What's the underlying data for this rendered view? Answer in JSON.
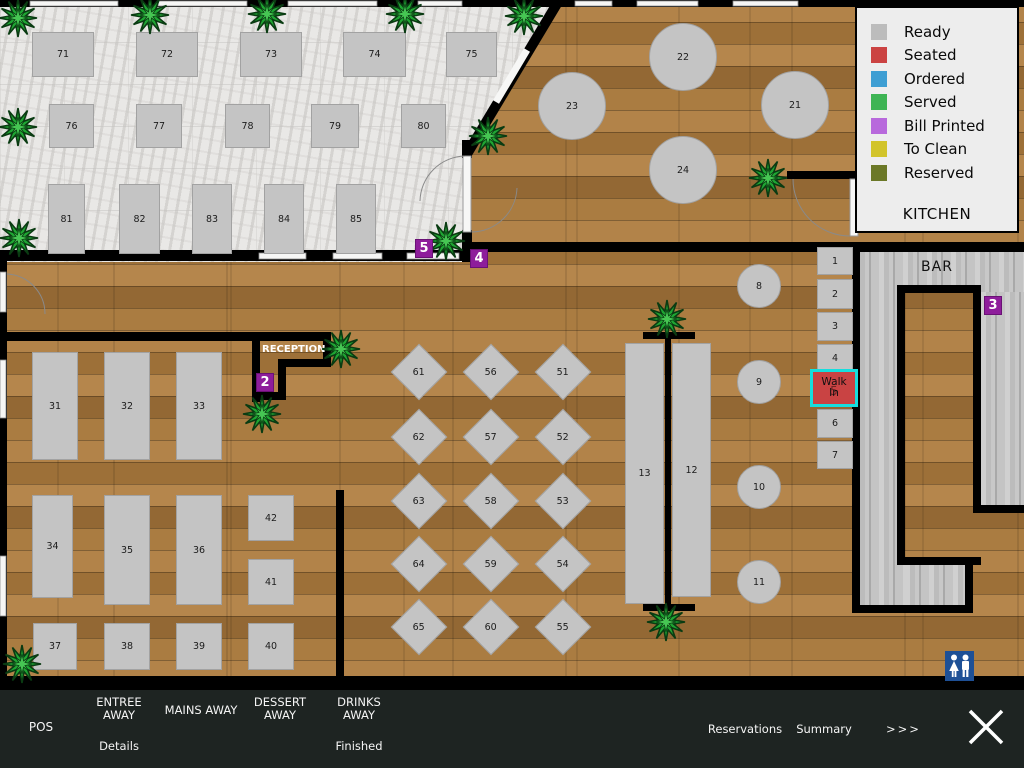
{
  "legend": {
    "items": [
      {
        "label": "Ready",
        "color": "#bcbcbc"
      },
      {
        "label": "Seated",
        "color": "#cb4342"
      },
      {
        "label": "Ordered",
        "color": "#3e9ed3"
      },
      {
        "label": "Served",
        "color": "#3eb454"
      },
      {
        "label": "Bill Printed",
        "color": "#b869dc"
      },
      {
        "label": "To Clean",
        "color": "#d2c42b"
      },
      {
        "label": "Reserved",
        "color": "#6b7827"
      }
    ],
    "kitchen_label": "KITCHEN"
  },
  "floor": {
    "bar_label": "BAR",
    "reception_label": "RECEPTION"
  },
  "walk_in": {
    "line1": "Walk",
    "line2": "In",
    "table_number": "5",
    "status": "seated",
    "fill_color": "#c94343",
    "highlight_color": "#16dede"
  },
  "markers": [
    {
      "label": "5",
      "x": 415,
      "y": 239
    },
    {
      "label": "4",
      "x": 470,
      "y": 249
    },
    {
      "label": "2",
      "x": 256,
      "y": 373
    },
    {
      "label": "3",
      "x": 984,
      "y": 296
    }
  ],
  "marker_color": "#8e1d9b",
  "tables": {
    "status_default": "ready",
    "rect": [
      {
        "id": "71",
        "x": 32,
        "y": 32,
        "w": 62,
        "h": 45
      },
      {
        "id": "72",
        "x": 136,
        "y": 32,
        "w": 62,
        "h": 45
      },
      {
        "id": "73",
        "x": 240,
        "y": 32,
        "w": 62,
        "h": 45
      },
      {
        "id": "74",
        "x": 343,
        "y": 32,
        "w": 63,
        "h": 45
      },
      {
        "id": "75",
        "x": 446,
        "y": 32,
        "w": 51,
        "h": 45
      },
      {
        "id": "76",
        "x": 49,
        "y": 104,
        "w": 45,
        "h": 44
      },
      {
        "id": "77",
        "x": 136,
        "y": 104,
        "w": 46,
        "h": 44
      },
      {
        "id": "78",
        "x": 225,
        "y": 104,
        "w": 45,
        "h": 44
      },
      {
        "id": "79",
        "x": 311,
        "y": 104,
        "w": 48,
        "h": 44
      },
      {
        "id": "80",
        "x": 401,
        "y": 104,
        "w": 45,
        "h": 44
      },
      {
        "id": "81",
        "x": 48,
        "y": 184,
        "w": 37,
        "h": 70
      },
      {
        "id": "82",
        "x": 119,
        "y": 184,
        "w": 41,
        "h": 70
      },
      {
        "id": "83",
        "x": 192,
        "y": 184,
        "w": 40,
        "h": 70
      },
      {
        "id": "84",
        "x": 264,
        "y": 184,
        "w": 40,
        "h": 70
      },
      {
        "id": "85",
        "x": 336,
        "y": 184,
        "w": 40,
        "h": 70
      },
      {
        "id": "31",
        "x": 32,
        "y": 352,
        "w": 46,
        "h": 108
      },
      {
        "id": "32",
        "x": 104,
        "y": 352,
        "w": 46,
        "h": 108
      },
      {
        "id": "33",
        "x": 176,
        "y": 352,
        "w": 46,
        "h": 108
      },
      {
        "id": "34",
        "x": 32,
        "y": 495,
        "w": 41,
        "h": 103
      },
      {
        "id": "35",
        "x": 104,
        "y": 495,
        "w": 46,
        "h": 110
      },
      {
        "id": "36",
        "x": 176,
        "y": 495,
        "w": 46,
        "h": 110
      },
      {
        "id": "42",
        "x": 248,
        "y": 495,
        "w": 46,
        "h": 46
      },
      {
        "id": "41",
        "x": 248,
        "y": 559,
        "w": 46,
        "h": 46
      },
      {
        "id": "37",
        "x": 33,
        "y": 623,
        "w": 44,
        "h": 47
      },
      {
        "id": "38",
        "x": 104,
        "y": 623,
        "w": 46,
        "h": 47
      },
      {
        "id": "39",
        "x": 176,
        "y": 623,
        "w": 46,
        "h": 47
      },
      {
        "id": "40",
        "x": 248,
        "y": 623,
        "w": 46,
        "h": 47
      },
      {
        "id": "13",
        "x": 625,
        "y": 343,
        "w": 39,
        "h": 261
      },
      {
        "id": "12",
        "x": 672,
        "y": 343,
        "w": 39,
        "h": 254
      },
      {
        "id": "1",
        "x": 817,
        "y": 247,
        "w": 36,
        "h": 28
      },
      {
        "id": "2",
        "x": 817,
        "y": 279,
        "w": 36,
        "h": 30
      },
      {
        "id": "3",
        "x": 817,
        "y": 312,
        "w": 36,
        "h": 29
      },
      {
        "id": "4",
        "x": 817,
        "y": 344,
        "w": 36,
        "h": 29
      },
      {
        "id": "6",
        "x": 817,
        "y": 409,
        "w": 36,
        "h": 29
      },
      {
        "id": "7",
        "x": 817,
        "y": 441,
        "w": 36,
        "h": 28
      }
    ],
    "round": [
      {
        "id": "22",
        "cx": 683,
        "cy": 57,
        "r": 34
      },
      {
        "id": "23",
        "cx": 572,
        "cy": 106,
        "r": 34
      },
      {
        "id": "21",
        "cx": 795,
        "cy": 105,
        "r": 34
      },
      {
        "id": "24",
        "cx": 683,
        "cy": 170,
        "r": 34
      },
      {
        "id": "8",
        "cx": 759,
        "cy": 286,
        "r": 22
      },
      {
        "id": "9",
        "cx": 759,
        "cy": 382,
        "r": 22
      },
      {
        "id": "10",
        "cx": 759,
        "cy": 487,
        "r": 22
      },
      {
        "id": "11",
        "cx": 759,
        "cy": 582,
        "r": 22
      }
    ],
    "diamond": [
      {
        "id": "61",
        "cx": 419,
        "cy": 372
      },
      {
        "id": "56",
        "cx": 491,
        "cy": 372
      },
      {
        "id": "51",
        "cx": 563,
        "cy": 372
      },
      {
        "id": "62",
        "cx": 419,
        "cy": 437
      },
      {
        "id": "57",
        "cx": 491,
        "cy": 437
      },
      {
        "id": "52",
        "cx": 563,
        "cy": 437
      },
      {
        "id": "63",
        "cx": 419,
        "cy": 501
      },
      {
        "id": "58",
        "cx": 491,
        "cy": 501
      },
      {
        "id": "53",
        "cx": 563,
        "cy": 501
      },
      {
        "id": "64",
        "cx": 419,
        "cy": 564
      },
      {
        "id": "59",
        "cx": 491,
        "cy": 564
      },
      {
        "id": "54",
        "cx": 563,
        "cy": 564
      },
      {
        "id": "65",
        "cx": 419,
        "cy": 627
      },
      {
        "id": "60",
        "cx": 491,
        "cy": 627
      },
      {
        "id": "55",
        "cx": 563,
        "cy": 627
      }
    ]
  },
  "plants": [
    [
      18,
      18
    ],
    [
      150,
      15
    ],
    [
      267,
      14
    ],
    [
      405,
      14
    ],
    [
      524,
      16
    ],
    [
      18,
      127
    ],
    [
      19,
      238
    ],
    [
      488,
      136
    ],
    [
      446,
      241
    ],
    [
      768,
      178
    ],
    [
      341,
      349
    ],
    [
      262,
      414
    ],
    [
      667,
      319
    ],
    [
      666,
      622
    ],
    [
      22,
      664
    ]
  ],
  "toolbar": {
    "pos": "POS",
    "entree": "ENTREE AWAY",
    "details": "Details",
    "mains": "MAINS AWAY",
    "dessert": "DESSERT AWAY",
    "drinks": "DRINKS AWAY",
    "finished": "Finished",
    "reservations": "Reservations",
    "summary": "Summary",
    "more": ">>>"
  }
}
